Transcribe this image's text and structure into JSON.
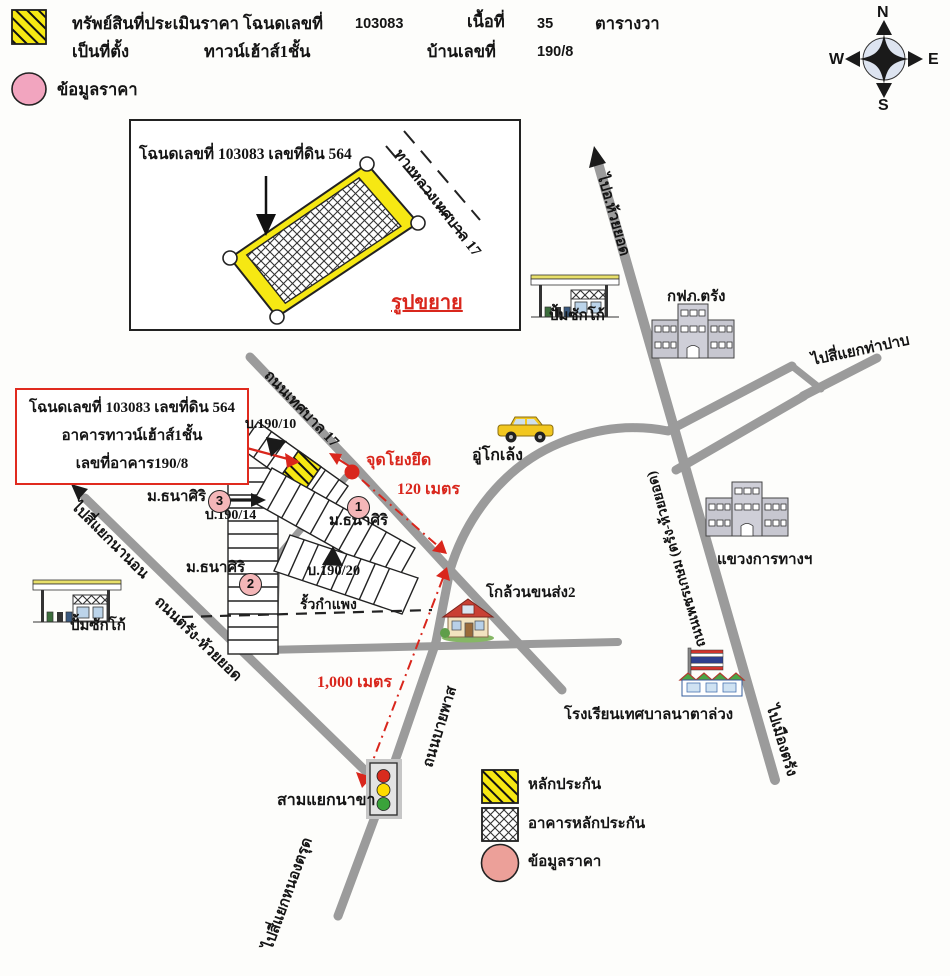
{
  "header": {
    "property_label": "ทรัพย์สินที่ประเมินราคา โฉนดเลขที่",
    "deed_no": "103083",
    "area_label": "เนื้อที่",
    "area_value": "35",
    "area_unit": "ตารางวา",
    "location_label": "เป็นที่ตั้ง",
    "building_type": "ทาวน์เฮ้าส์1ชั้น",
    "house_no_label": "บ้านเลขที่",
    "house_no": "190/8",
    "price_info_label": "ข้อมูลราคา"
  },
  "compass": {
    "north": "N",
    "east": "E",
    "south": "S",
    "west": "W"
  },
  "inset": {
    "parcel_label": "โฉนดเลขที่ 103083 เลขที่ดิน 564",
    "road_label": "ทางหลวงเทศบาล 17",
    "caption": "รูปขยาย"
  },
  "callout": {
    "line1": "โฉนดเลขที่ 103083 เลขที่ดิน 564",
    "line2": "อาคารทาวน์เฮ้าส์1ชั้น",
    "line3": "เลขที่อาคาร190/8"
  },
  "roads": {
    "to_huai_yot": "ไปอ.ห้วยยอด",
    "phetkasem": "ถนนเพชรเกษม (ตรัง-ห้วยยอด)",
    "to_tha_pap": "ไปสี่แยกท่าปาบ",
    "to_mueang_trang": "ไปเมืองตรัง",
    "thesaban_17": "ถนนเทศบาล 17",
    "bypass": "ถนนบายพาส",
    "trang_huai_yot": "ถนนตรัง-ห้วยยอด",
    "to_na_non": "ไปสี่แยกนานอน",
    "to_nong_trut": "ไปสี่แยกหนองตรุด"
  },
  "places": {
    "gas_station_top": "ปั้มซักโก้",
    "gas_station_left": "ปั้มซักโก้",
    "pea_trang": "กฟภ.ตรัง",
    "highway_office": "แขวงการทางฯ",
    "garage": "อู่โกเล้ง",
    "transport_depot": "โกล้วนขนส่ง2",
    "school": "โรงเรียนเทศบาลนาตาล่วง",
    "junction": "สามแยกนาขา"
  },
  "markers": {
    "tie_point": "จุดโยงยึด",
    "fence": "รั้วกำแพง",
    "house_190_10": "บ.190/10",
    "house_190_14": "บ.190/14",
    "house_190_20": "บ.190/20",
    "village_1": "ม.ธนาศิริ",
    "village_2": "ม.ธนาศิริ",
    "village_3": "ม.ธนาศิริ",
    "point_1": "1",
    "point_2": "2",
    "point_3": "3"
  },
  "distances": {
    "to_junction_x": "120 เมตร",
    "to_na_kha": "1,000 เมตร"
  },
  "legend": {
    "collateral": "หลักประกัน",
    "collateral_building": "อาคารหลักประกัน",
    "price_info": "ข้อมูลราคา"
  },
  "colors": {
    "collateral_yellow": "#f6e813",
    "road_gray": "#9b9b9b",
    "highlight_red": "#d9261c",
    "price_pink": "#f2a5bf",
    "legend_pink": "#eca099"
  }
}
